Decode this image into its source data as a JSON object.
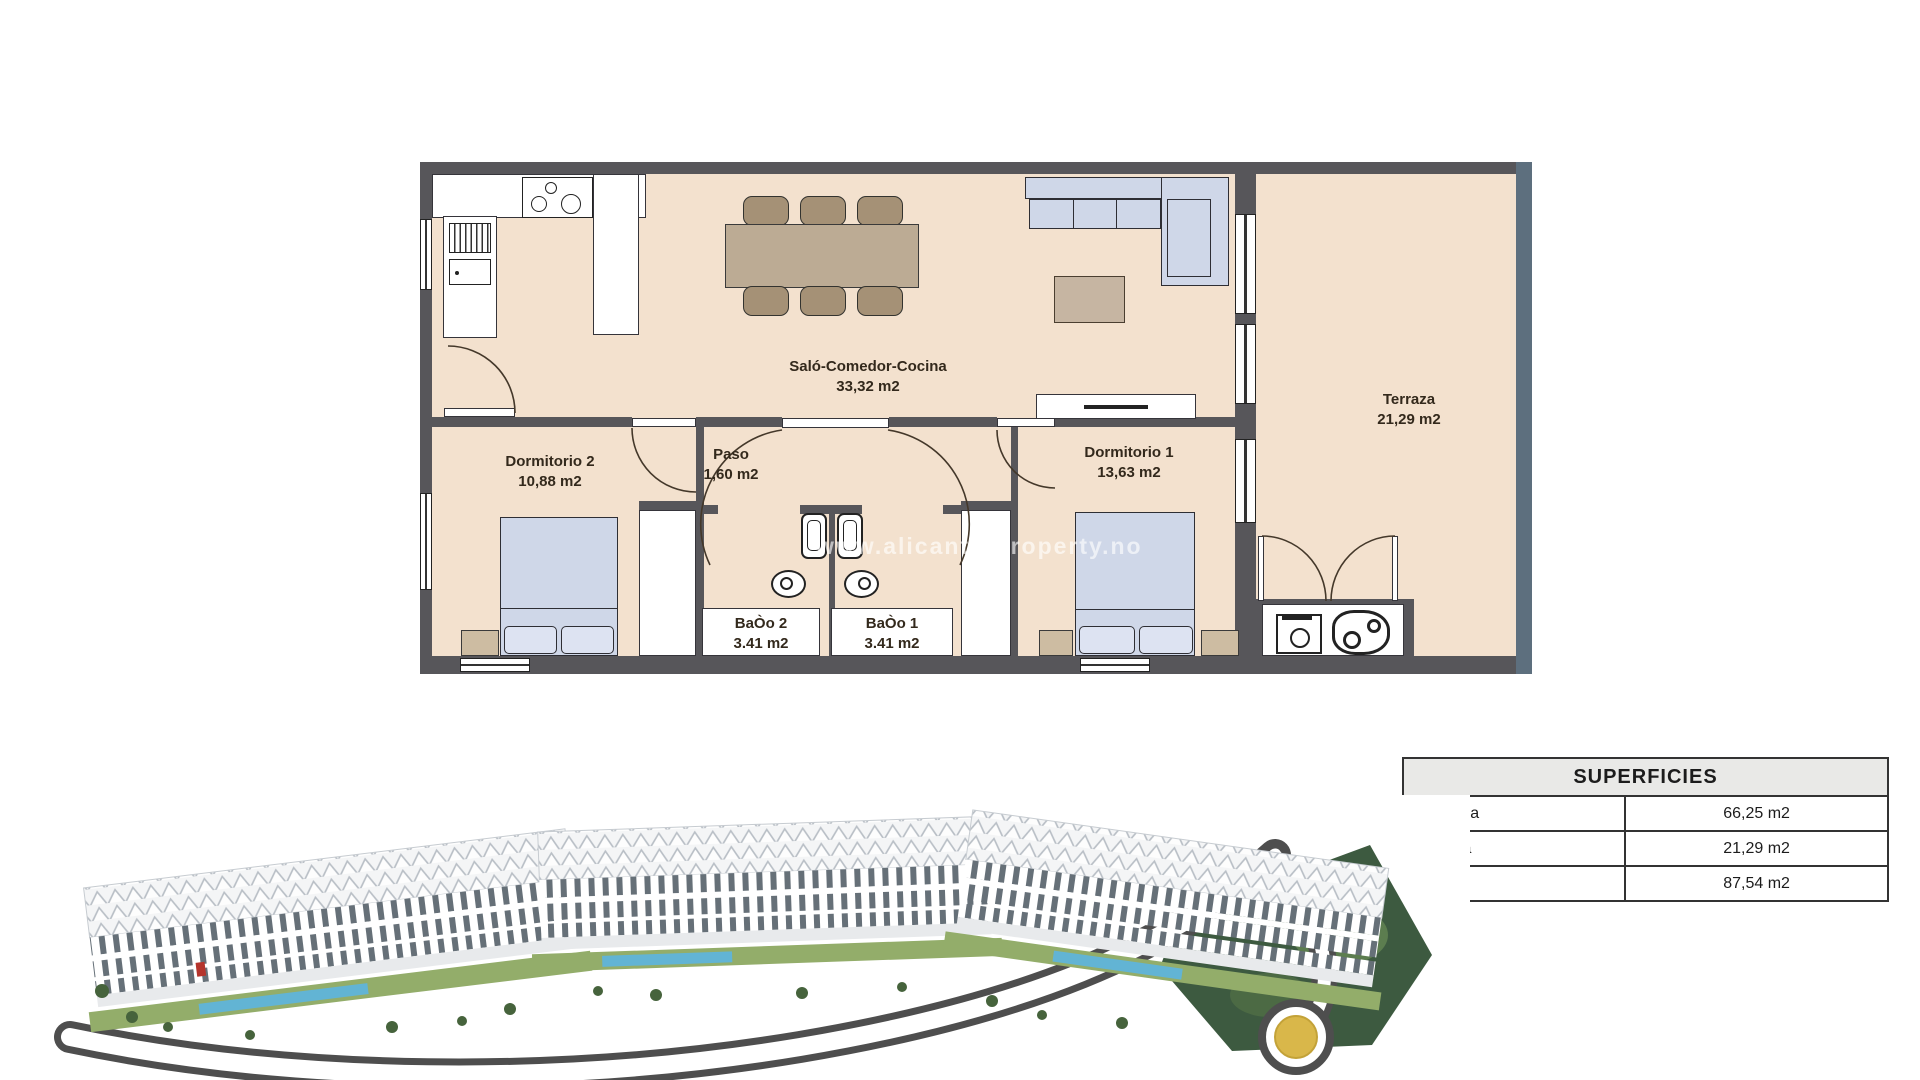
{
  "floorplan": {
    "rooms": [
      {
        "name": "Saló-Comedor-Cocina",
        "area": "33,32 m2"
      },
      {
        "name": "Terraza",
        "area": "21,29 m2"
      },
      {
        "name": "Dormitorio 2",
        "area": "10,88 m2"
      },
      {
        "name": "Paso",
        "area": "1,60 m2"
      },
      {
        "name": "Dormitorio 1",
        "area": "13,63 m2"
      },
      {
        "name": "BaÒo 2",
        "area": "3.41 m2"
      },
      {
        "name": "BaÒo 1",
        "area": "3.41 m2"
      }
    ],
    "watermark": "www.alicante-property.no"
  },
  "superficies_table": {
    "title": "SUPERFICIES",
    "rows": [
      {
        "label": "Vivienda",
        "value": "66,25 m2"
      },
      {
        "label": "Terraza",
        "value": "21,29 m2"
      },
      {
        "label": "Total",
        "value": "87,54 m2"
      }
    ]
  },
  "colors": {
    "floor": "#f3e1ce",
    "wall": "#57565a",
    "exterior_band": "#5d6f7e",
    "furniture_blue": "#cfd7e8",
    "furniture_wood": "#bcab94",
    "table_header_bg": "#e9e9e7",
    "roundabout_gold": "#d9b74a"
  }
}
